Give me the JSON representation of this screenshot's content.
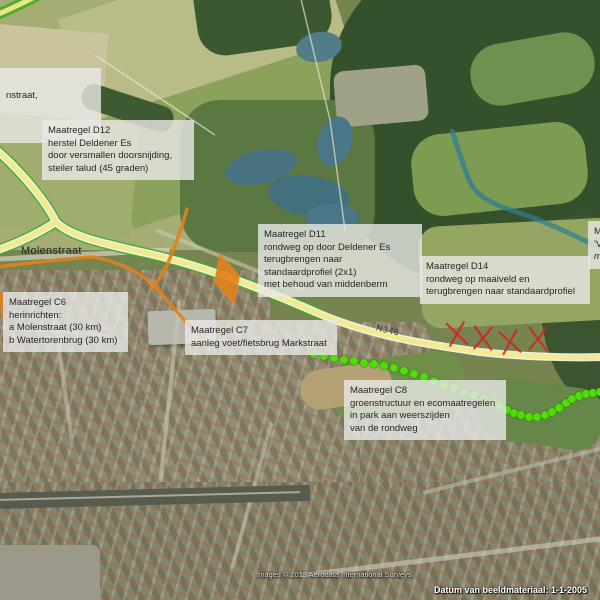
{
  "map": {
    "road_label_molenstraat": "Molenstraat",
    "road_label_n346": "N346",
    "attribution": "Images © 2013 Aerodata International Surveys",
    "footer_date": "Datum van beeldmateriaal: 1-1-2005",
    "footer_coords": "52°15'5",
    "colors": {
      "measure_route_orange": "#e0821e",
      "ring_road_yellow": "#f2e98b",
      "road_casing": "#fdfdef",
      "road_edge_green": "#44aa22",
      "eco_dot_green": "#52dd0a",
      "removed_x_red": "#cb2727",
      "stream_teal": "#2b7d96",
      "label_bg": "rgba(233,233,230,0.80)",
      "label_text": "#262626"
    }
  },
  "labels": {
    "partial_left": {
      "lines": [
        "nstraat,"
      ]
    },
    "d12": {
      "lines": [
        "Maatregel D12",
        "herstel Deldener Es",
        "door versmallen doorsnijding,",
        "steiler talud (45 graden)"
      ]
    },
    "c6": {
      "lines": [
        "Maatregel C6",
        "herinrichten:",
        "a Molenstraat (30 km)",
        "b Watertorenbrug (30 km)"
      ]
    },
    "d11": {
      "lines": [
        "Maatregel D11",
        "rondweg op door Deldener Es",
        "terugbrengen naar",
        "standaardprofiel (2x1)",
        "met behoud van middenberm"
      ]
    },
    "d14": {
      "lines": [
        "Maatregel D14",
        "rondweg op maaiveld en",
        "terugbrengen naar standaardprofiel"
      ]
    },
    "c7": {
      "lines": [
        "Maatregel C7",
        "aanleg voet/fietsbrug Markstraat"
      ]
    },
    "c8": {
      "lines": [
        "Maatregel C8",
        "groenstructuur en ecomaatregelen",
        "in park  aan weerszijden",
        "van de rondweg"
      ]
    },
    "partial_right": {
      "lines": [
        "M",
        "'V",
        "m"
      ]
    }
  },
  "overlay": {
    "eco_dots": [
      [
        314,
        354
      ],
      [
        324,
        356
      ],
      [
        334,
        358
      ],
      [
        344,
        360
      ],
      [
        354,
        361
      ],
      [
        364,
        363
      ],
      [
        374,
        364
      ],
      [
        384,
        366
      ],
      [
        394,
        368
      ],
      [
        404,
        371
      ],
      [
        414,
        374
      ],
      [
        424,
        377
      ],
      [
        434,
        381
      ],
      [
        444,
        385
      ],
      [
        454,
        388
      ],
      [
        464,
        392
      ],
      [
        474,
        395
      ],
      [
        484,
        398
      ],
      [
        493,
        402
      ],
      [
        500,
        406
      ],
      [
        507,
        410
      ],
      [
        514,
        413
      ],
      [
        521,
        415
      ],
      [
        529,
        417
      ],
      [
        537,
        417
      ],
      [
        545,
        415
      ],
      [
        552,
        412
      ],
      [
        559,
        408
      ],
      [
        566,
        403
      ],
      [
        572,
        399
      ],
      [
        579,
        396
      ],
      [
        586,
        394
      ],
      [
        593,
        393
      ],
      [
        600,
        392
      ]
    ],
    "x_marks": [
      [
        457,
        334,
        -6
      ],
      [
        483,
        338,
        4
      ],
      [
        510,
        342,
        -8
      ],
      [
        538,
        339,
        3
      ]
    ]
  }
}
